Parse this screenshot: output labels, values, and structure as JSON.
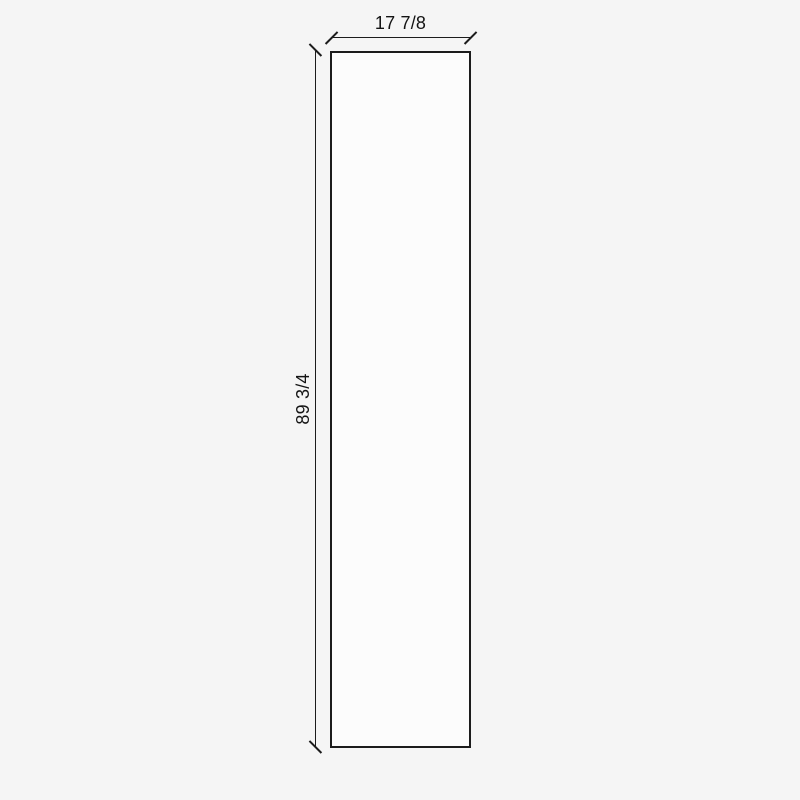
{
  "colors": {
    "background": "#f5f5f5",
    "panel_fill": "#fcfcfc",
    "line": "#1c1c1c",
    "text": "#141414"
  },
  "drawing": {
    "type": "dimensioned panel elevation",
    "width_label": "17 7/8",
    "height_label": "89 3/4"
  }
}
